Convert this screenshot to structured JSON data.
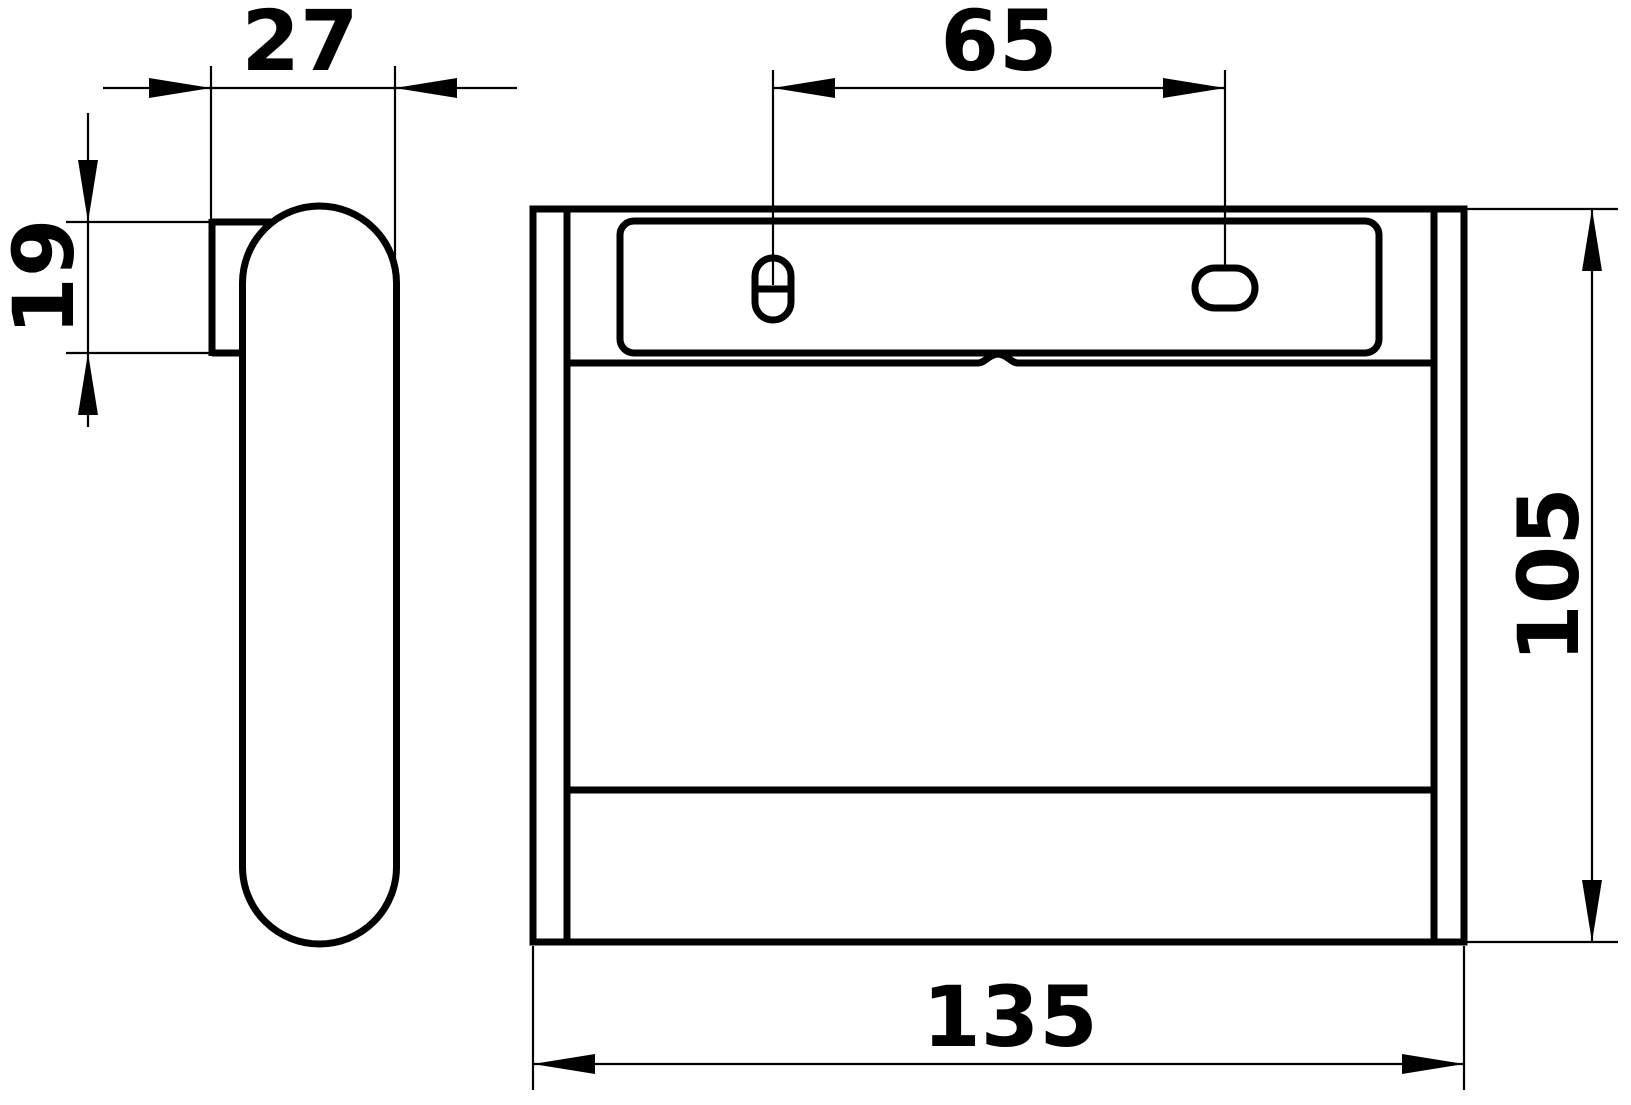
{
  "drawing": {
    "dimensions": {
      "side_depth": "27",
      "bracket_height": "19",
      "hole_spacing": "65",
      "body_height": "105",
      "body_width": "135"
    },
    "colors": {
      "line": "#000000",
      "background": "#ffffff"
    }
  }
}
